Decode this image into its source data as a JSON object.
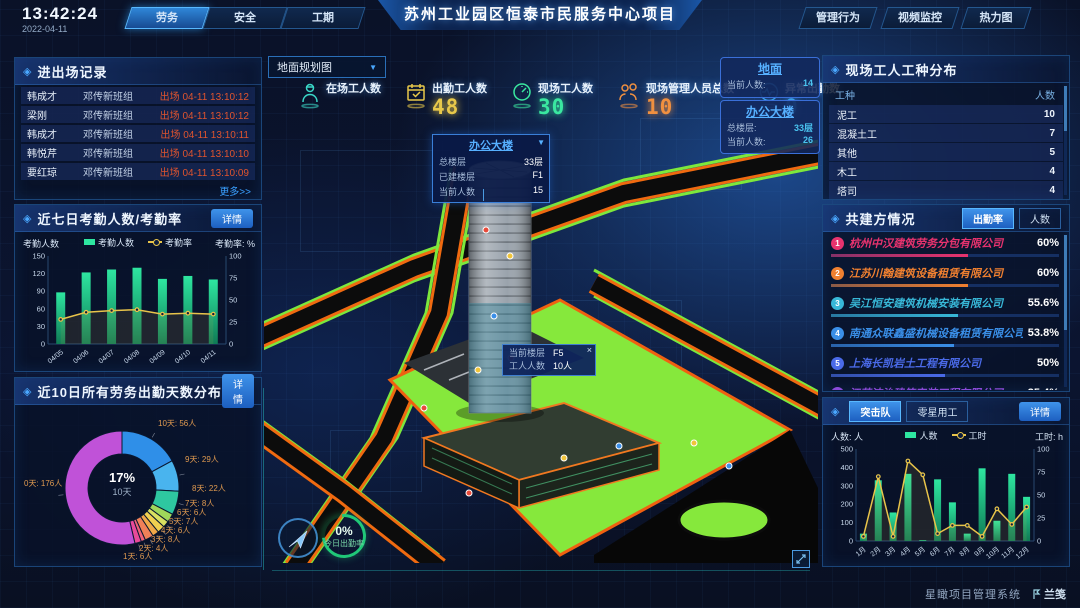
{
  "topbar": {
    "time": "13:42:24",
    "date": "2022-04-11",
    "left_tabs": [
      {
        "label": "劳务",
        "active": true
      },
      {
        "label": "安全",
        "active": false
      },
      {
        "label": "工期",
        "active": false
      }
    ],
    "title": "苏州工业园区恒泰市民服务中心项目",
    "right_tabs": [
      "管理行为",
      "视频监控",
      "热力图"
    ]
  },
  "panels": {
    "entry": {
      "title": "进出场记录",
      "more": "更多>>",
      "rows": [
        {
          "name": "韩成才",
          "group": "邓传新班组",
          "event": "出场 04-11 13:10:12"
        },
        {
          "name": "梁刚",
          "group": "邓传新班组",
          "event": "出场 04-11 13:10:12"
        },
        {
          "name": "韩成才",
          "group": "邓传新班组",
          "event": "出场 04-11 13:10:11"
        },
        {
          "name": "韩悦芹",
          "group": "邓传新班组",
          "event": "出场 04-11 13:10:10"
        },
        {
          "name": "要红琼",
          "group": "邓传新班组",
          "event": "出场 04-11 13:10:09"
        }
      ]
    },
    "attendance": {
      "title": "近七日考勤人数/考勤率",
      "detail": "详情"
    },
    "distribution": {
      "title": "近10日所有劳务出勤天数分布",
      "detail": "详情"
    },
    "worker_types": {
      "title": "现场工人工种分布",
      "headers": [
        "工种",
        "人数"
      ],
      "rows": [
        {
          "type": "泥工",
          "count": "10"
        },
        {
          "type": "混凝土工",
          "count": "7"
        },
        {
          "type": "其他",
          "count": "5"
        },
        {
          "type": "木工",
          "count": "4"
        },
        {
          "type": "塔司",
          "count": "4"
        }
      ]
    },
    "partners": {
      "title": "共建方情况",
      "tabs": [
        {
          "label": "出勤率",
          "active": true
        },
        {
          "label": "人数",
          "active": false
        }
      ],
      "rows": [
        {
          "rank": "1",
          "name": "杭州中汉建筑劳务分包有限公司",
          "value": "60%",
          "pct": 60,
          "color": "#e8336e"
        },
        {
          "rank": "2",
          "name": "江苏川翰建筑设备租赁有限公司",
          "value": "60%",
          "pct": 60,
          "color": "#f08030"
        },
        {
          "rank": "3",
          "name": "吴江恒安建筑机械安装有限公司",
          "value": "55.6%",
          "pct": 55.6,
          "color": "#38b8d8"
        },
        {
          "rank": "4",
          "name": "南通众联鑫盛机械设备租赁有限公司",
          "value": "53.8%",
          "pct": 53.8,
          "color": "#3a8fe8"
        },
        {
          "rank": "5",
          "name": "上海长凯岩土工程有限公司",
          "value": "50%",
          "pct": 50,
          "color": "#4a6ae8"
        },
        {
          "rank": "6",
          "name": "江苏洁治建筑安装工程有限公司",
          "value": "35.4%",
          "pct": 35.4,
          "color": "#8a4ad8"
        }
      ]
    },
    "assault": {
      "tabs": [
        {
          "label": "突击队",
          "active": true
        },
        {
          "label": "零星用工",
          "active": false
        }
      ],
      "detail": "详情"
    }
  },
  "scene": {
    "view_select": "地面规划图",
    "stats": [
      {
        "label": "在场工人数",
        "value": ""
      },
      {
        "label": "出勤工人数",
        "value": "48"
      },
      {
        "label": "现场工人数",
        "value": "30"
      },
      {
        "label": "现场管理人员总数",
        "value": "10"
      },
      {
        "label": "异常出勤数",
        "value": "0"
      }
    ],
    "cards": [
      {
        "title": "地面",
        "rows": [
          {
            "label": "当前人数:",
            "value": "14"
          }
        ]
      },
      {
        "title": "办公大楼",
        "rows": [
          {
            "label": "总楼层:",
            "value": "33层"
          },
          {
            "label": "当前人数:",
            "value": "26"
          }
        ]
      }
    ],
    "building_tooltip": {
      "title": "办公大楼",
      "rows": [
        {
          "label": "总楼层",
          "value": "33层"
        },
        {
          "label": "已建楼层",
          "value": "F1"
        },
        {
          "label": "当前人数",
          "value": "15"
        }
      ]
    },
    "floor_tooltip": {
      "close": "×",
      "rows": [
        {
          "label": "当前楼层",
          "value": "F5"
        },
        {
          "label": "工人人数",
          "value": "10人"
        }
      ]
    },
    "gauge": {
      "value": "0%",
      "label": "今日出勤率"
    }
  },
  "footer": {
    "system": "星瞰项目管理系统",
    "brand": "兰笺"
  },
  "colors": {
    "accent": "#2a7de1",
    "alert": "#e0542e",
    "link": "#3aa0ff",
    "bar": "#2ee6a0",
    "line": "#e8c44a"
  },
  "chart_data": [
    {
      "id": "attendance7d",
      "type": "bar",
      "title": "近七日考勤人数/考勤率",
      "categories": [
        "04/05",
        "04/06",
        "04/07",
        "04/08",
        "04/09",
        "04/10",
        "04/11"
      ],
      "series": [
        {
          "name": "考勤人数",
          "type": "bar",
          "axis": "left",
          "values": [
            88,
            122,
            127,
            130,
            111,
            116,
            110
          ],
          "color": "#2ee6a0"
        },
        {
          "name": "考勤率",
          "type": "line",
          "axis": "right",
          "values": [
            28,
            36,
            38,
            39,
            34,
            35,
            34
          ],
          "color": "#e8c44a"
        }
      ],
      "ylabel": "考勤人数",
      "y2label": "考勤率: %",
      "ylim": [
        0,
        150
      ],
      "y2lim": [
        0,
        100
      ],
      "yticks": [
        0,
        30,
        60,
        90,
        120,
        150
      ],
      "y2ticks": [
        0,
        25,
        50,
        75,
        100
      ],
      "legend_position": "top",
      "grid": false
    },
    {
      "id": "attendanceDays10d",
      "type": "pie",
      "title": "近10日所有劳务出勤天数分布",
      "center_pct": "17%",
      "center_label": "10天",
      "slices": [
        {
          "label": "10天",
          "value": 56,
          "text": "10天: 56人",
          "color": "#2f8fe8"
        },
        {
          "label": "9天",
          "value": 29,
          "text": "9天: 29人",
          "color": "#49b4ee"
        },
        {
          "label": "8天",
          "value": 22,
          "text": "8天: 22人",
          "color": "#2ec7a0"
        },
        {
          "label": "7天",
          "value": 8,
          "text": "7天: 8人",
          "color": "#a0d85a"
        },
        {
          "label": "6天",
          "value": 6,
          "text": "6天: 6人",
          "color": "#d8e060"
        },
        {
          "label": "5天",
          "value": 7,
          "text": "5天: 7人",
          "color": "#f0d050"
        },
        {
          "label": "4天",
          "value": 6,
          "text": "4天: 6人",
          "color": "#f0a848"
        },
        {
          "label": "3天",
          "value": 8,
          "text": "3天: 8人",
          "color": "#f08058"
        },
        {
          "label": "2天",
          "value": 4,
          "text": "2天: 4人",
          "color": "#ee6078"
        },
        {
          "label": "1天",
          "value": 6,
          "text": "1天: 6人",
          "color": "#e84a9a"
        },
        {
          "label": "0天",
          "value": 176,
          "text": "0天: 176人",
          "color": "#c052d8"
        }
      ]
    },
    {
      "id": "assaultMonthly",
      "type": "bar",
      "title": "突击队人数/工时",
      "categories": [
        "1月",
        "2月",
        "3月",
        "4月",
        "5月",
        "6月",
        "7月",
        "8月",
        "9月",
        "10月",
        "11月",
        "12月"
      ],
      "series": [
        {
          "name": "人数",
          "type": "bar",
          "axis": "left",
          "values": [
            40,
            330,
            155,
            365,
            5,
            335,
            210,
            40,
            395,
            110,
            365,
            240
          ],
          "color": "#2ee6a0"
        },
        {
          "name": "工时",
          "type": "line",
          "axis": "right",
          "values": [
            5,
            70,
            5,
            87,
            72,
            8,
            17,
            17,
            5,
            35,
            18,
            37
          ],
          "color": "#e8c44a"
        }
      ],
      "ylabel": "人数: 人",
      "y2label": "工时: h",
      "ylim": [
        0,
        500
      ],
      "y2lim": [
        0,
        100
      ],
      "yticks": [
        0,
        100,
        200,
        300,
        400,
        500
      ],
      "y2ticks": [
        0,
        25,
        50,
        75,
        100
      ],
      "legend_position": "top",
      "grid": false
    }
  ]
}
